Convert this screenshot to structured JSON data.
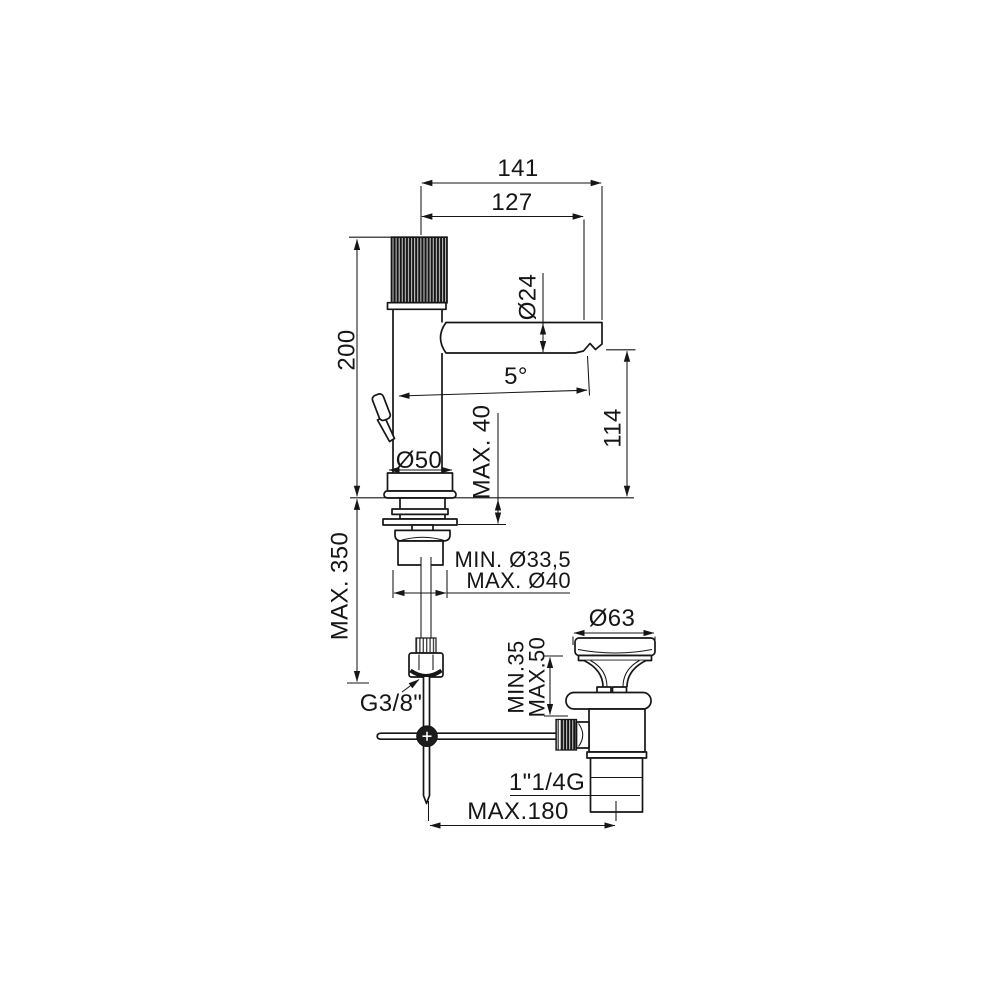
{
  "drawing": {
    "type": "technical-dimension-drawing",
    "subject": "single-lever basin mixer tap with pop-up waste",
    "colors": {
      "line": "#161616",
      "background": "#ffffff"
    }
  },
  "labels": {
    "reach_tip": "141",
    "reach_aerator": "127",
    "spout_dia": "Ø24",
    "spout_angle": "5°",
    "outlet_height": "114",
    "body_height": "200",
    "hose_length": "MAX. 350",
    "base_dia": "Ø50",
    "deck_thickness": "MAX. 40",
    "hole_min": "MIN. Ø33,5",
    "hole_max": "MAX. Ø40",
    "inlet_thread": "G3/8\"",
    "waste_cap_dia": "Ø63",
    "waste_clamp_min": "MIN.35",
    "waste_clamp_max": "MAX.50",
    "waste_thread": "1\"1/4G",
    "rod_offset": "MAX.180"
  }
}
